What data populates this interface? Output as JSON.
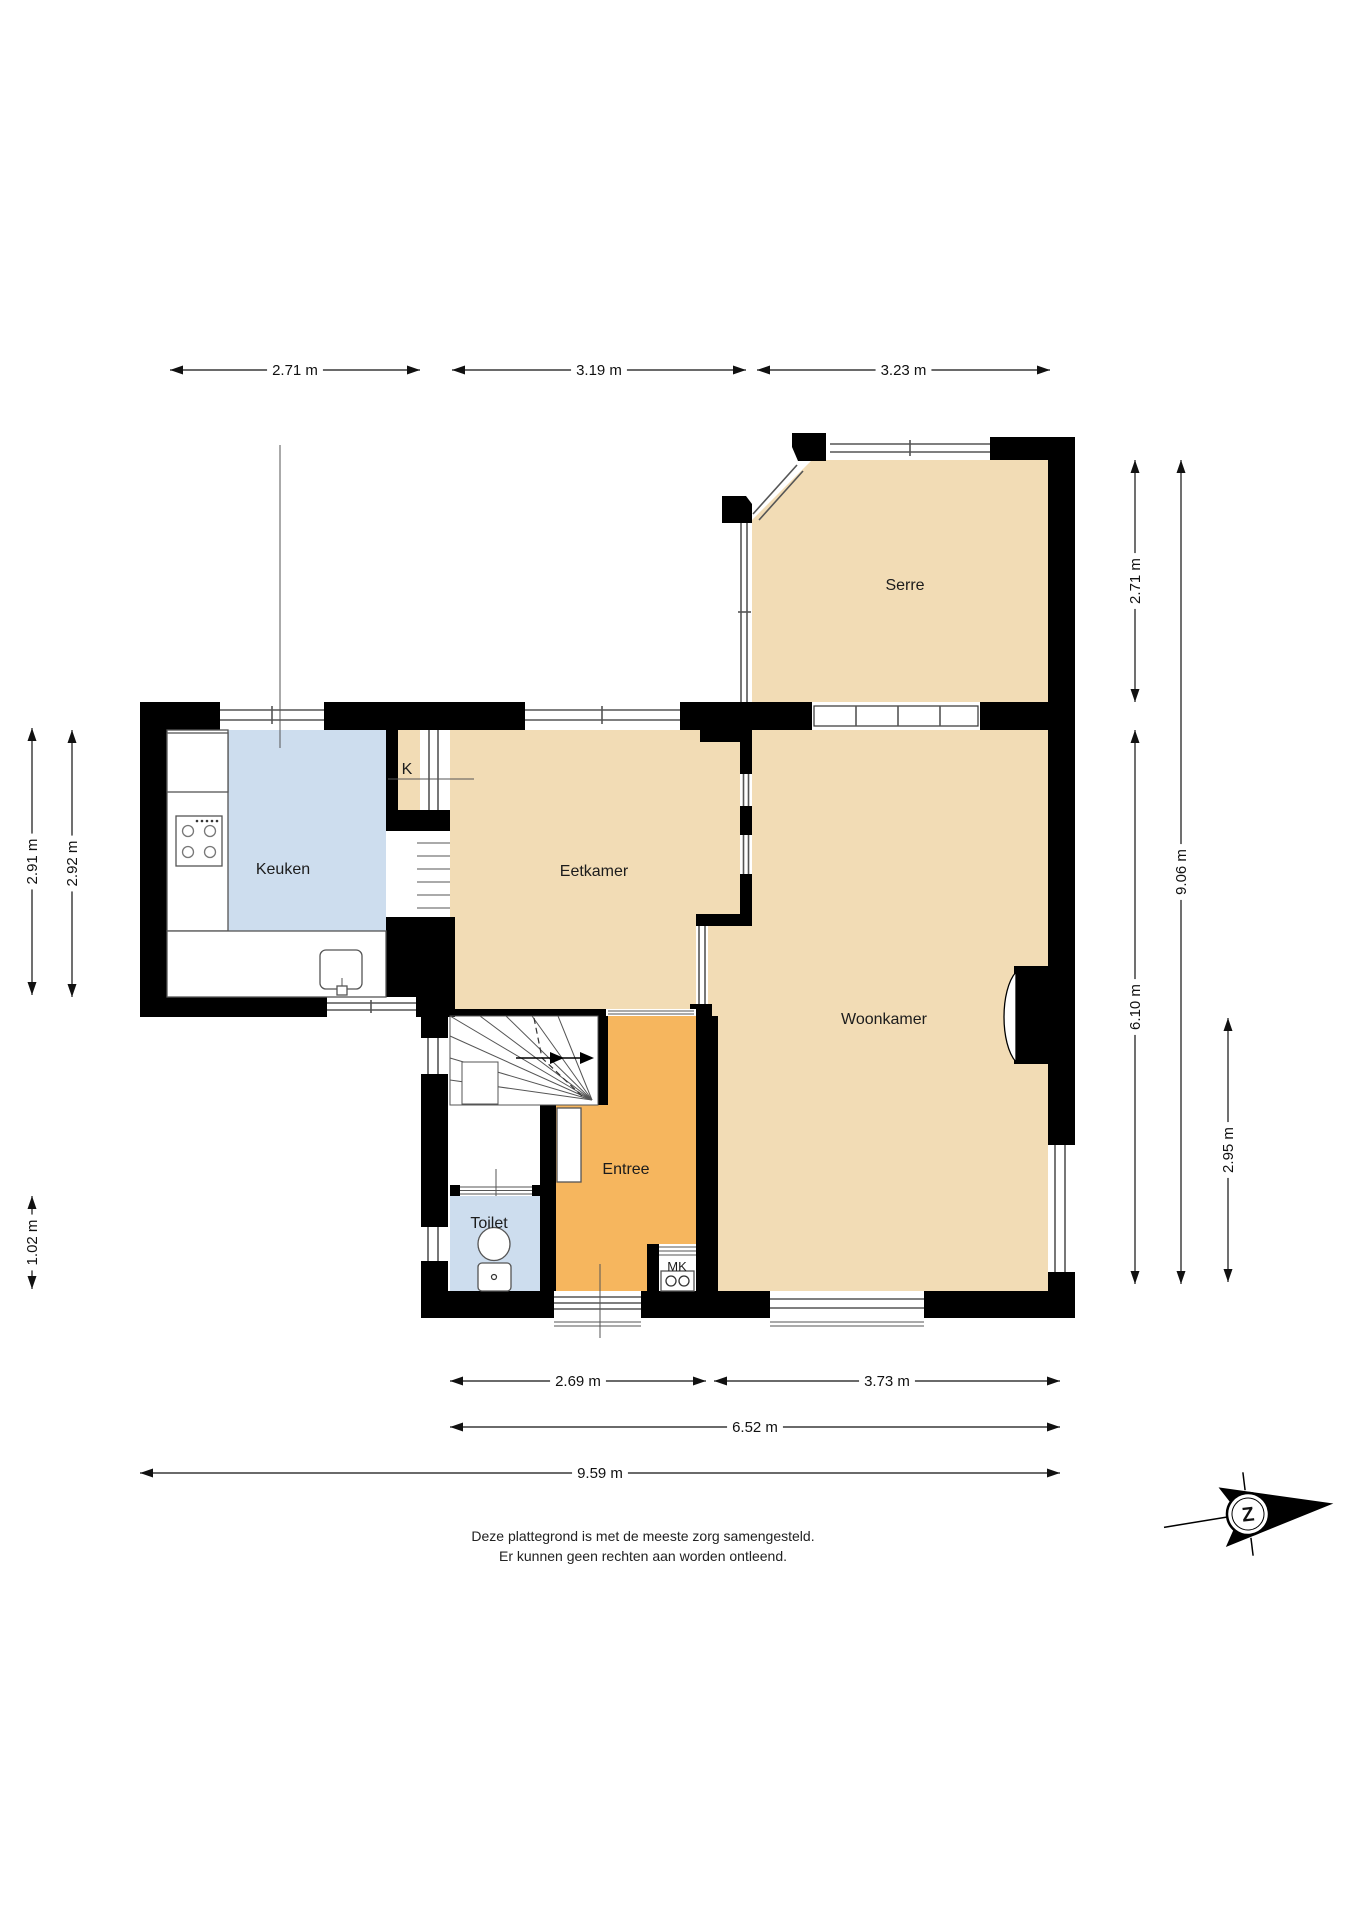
{
  "plan_title": "Begane grond plattegrond",
  "rooms": {
    "serre": {
      "label": "Serre",
      "x": 905,
      "y": 585
    },
    "keuken": {
      "label": "Keuken",
      "x": 283,
      "y": 868
    },
    "k": {
      "label": "K",
      "x": 407,
      "y": 768
    },
    "eetkamer": {
      "label": "Eetkamer",
      "x": 594,
      "y": 870
    },
    "woonkamer": {
      "label": "Woonkamer",
      "x": 884,
      "y": 1018
    },
    "entree": {
      "label": "Entree",
      "x": 626,
      "y": 1168
    },
    "toilet": {
      "label": "Toilet",
      "x": 489,
      "y": 1222
    },
    "mk": {
      "label": "MK",
      "x": 677,
      "y": 1267
    }
  },
  "dimensions": [
    {
      "label": "2.71 m",
      "orient": "h",
      "x1": 170,
      "x2": 420,
      "y": 370
    },
    {
      "label": "3.19 m",
      "orient": "h",
      "x1": 452,
      "x2": 746,
      "y": 370
    },
    {
      "label": "3.23 m",
      "orient": "h",
      "x1": 757,
      "x2": 1050,
      "y": 370
    },
    {
      "label": "2.69 m",
      "orient": "h",
      "x1": 450,
      "x2": 706,
      "y": 1381
    },
    {
      "label": "3.73 m",
      "orient": "h",
      "x1": 714,
      "x2": 1060,
      "y": 1381
    },
    {
      "label": "6.52 m",
      "orient": "h",
      "x1": 450,
      "x2": 1060,
      "y": 1427
    },
    {
      "label": "9.59 m",
      "orient": "h",
      "x1": 140,
      "x2": 1060,
      "y": 1473,
      "labelAt": 600
    },
    {
      "label": "2.91 m",
      "orient": "v",
      "y1": 728,
      "y2": 995,
      "x": 32
    },
    {
      "label": "2.92 m",
      "orient": "v",
      "y1": 730,
      "y2": 997,
      "x": 72
    },
    {
      "label": "1.02 m",
      "orient": "v",
      "y1": 1196,
      "y2": 1289,
      "x": 32
    },
    {
      "label": "2.71 m",
      "orient": "v",
      "y1": 460,
      "y2": 702,
      "x": 1135
    },
    {
      "label": "6.10 m",
      "orient": "v",
      "y1": 730,
      "y2": 1284,
      "x": 1135
    },
    {
      "label": "9.06 m",
      "orient": "v",
      "y1": 460,
      "y2": 1284,
      "x": 1181
    },
    {
      "label": "2.95 m",
      "orient": "v",
      "y1": 1018,
      "y2": 1282,
      "x": 1228
    }
  ],
  "disclaimer": {
    "line1": "Deze plattegrond is met de meeste zorg samengesteld.",
    "line2": "Er kunnen geen rechten aan worden ontleend."
  },
  "compass": {
    "letter": "Z"
  },
  "colors": {
    "floor_tan": "#f2dcb5",
    "floor_orange": "#f6b65e",
    "floor_blue": "#cdddee",
    "wall": "#000000",
    "line": "#555555"
  }
}
